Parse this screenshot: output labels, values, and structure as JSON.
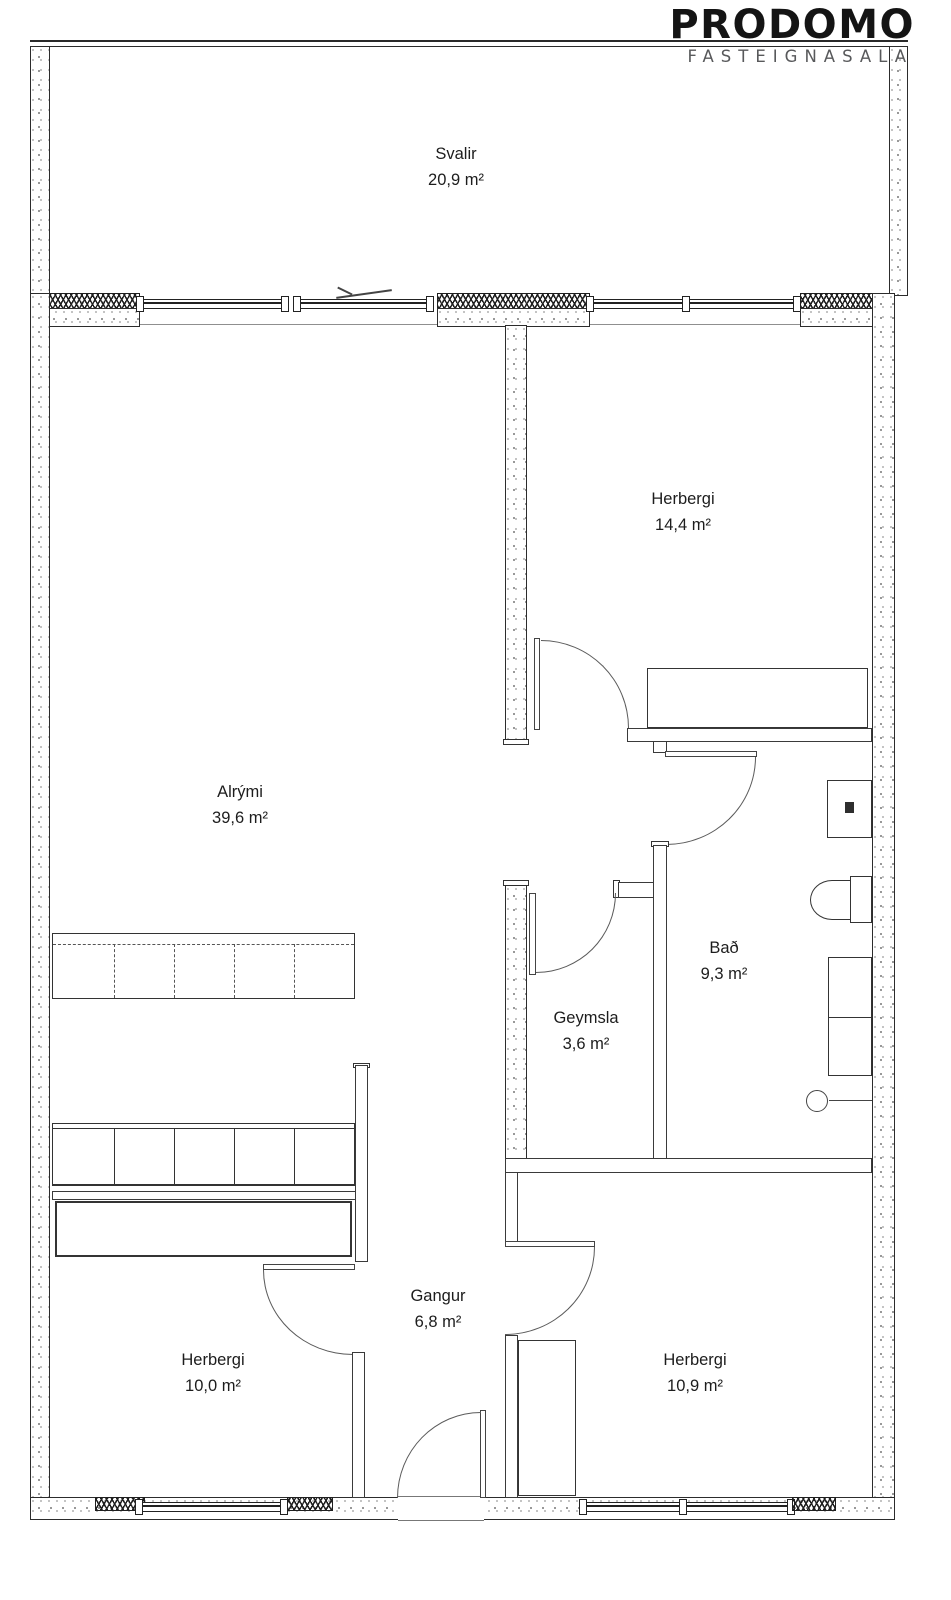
{
  "brand": {
    "name": "PRODOMO",
    "subtitle": "FASTEIGNASALA"
  },
  "rooms": [
    {
      "id": "svalir",
      "name": "Svalir",
      "area": "20,9 m²"
    },
    {
      "id": "herbergi-top",
      "name": "Herbergi",
      "area": "14,4 m²"
    },
    {
      "id": "alrymi",
      "name": "Alrými",
      "area": "39,6 m²"
    },
    {
      "id": "bad",
      "name": "Bað",
      "area": "9,3 m²"
    },
    {
      "id": "geymsla",
      "name": "Geymsla",
      "area": "3,6 m²"
    },
    {
      "id": "gangur",
      "name": "Gangur",
      "area": "6,8 m²"
    },
    {
      "id": "herbergi-bottom-left",
      "name": "Herbergi",
      "area": "10,0 m²"
    },
    {
      "id": "herbergi-bottom-right",
      "name": "Herbergi",
      "area": "10,9 m²"
    }
  ],
  "colors": {
    "wall_line": "#2c2c2c",
    "text": "#1d1d1d",
    "brand_text": "#141414",
    "brand_subtext": "#58595b"
  }
}
